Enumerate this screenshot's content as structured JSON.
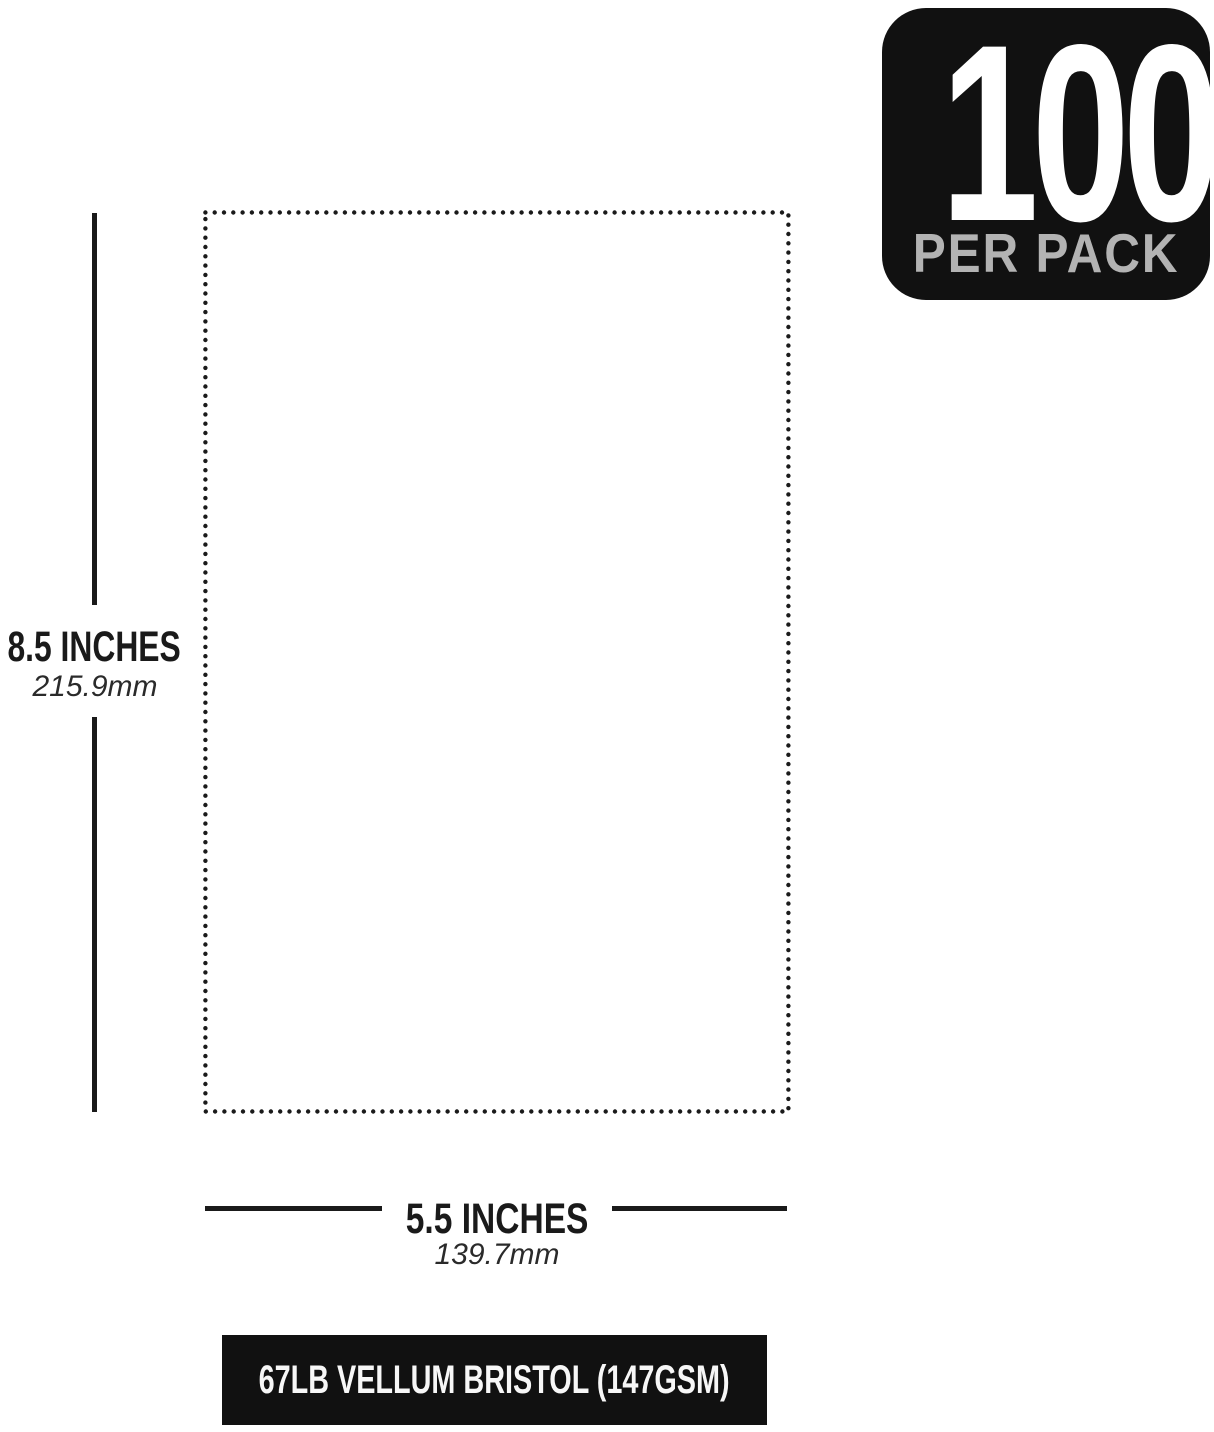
{
  "badge": {
    "count": "100",
    "label": "PER PACK",
    "bg_color": "#111111",
    "count_color": "#ffffff",
    "label_color": "#b3b3b3"
  },
  "height_dimension": {
    "inches_label": "8.5 INCHES",
    "mm_label": "215.9mm"
  },
  "width_dimension": {
    "inches_label": "5.5 INCHES",
    "mm_label": "139.7mm"
  },
  "paper_spec": {
    "label": "67LB VELLUM BRISTOL (147GSM)",
    "bg_color": "#111111",
    "text_color": "#f7f7f7"
  },
  "colors": {
    "background": "#ffffff",
    "ink": "#1a1a1a"
  }
}
